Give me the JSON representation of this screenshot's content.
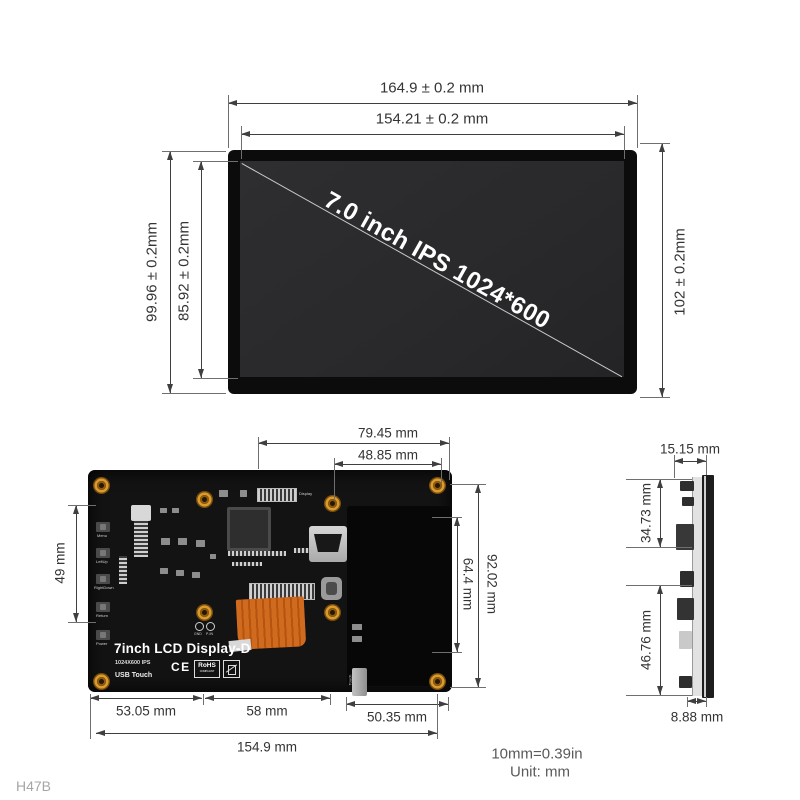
{
  "front_view": {
    "screen_label": "7.0 inch IPS 1024*600",
    "dims": {
      "width_outer": "164.9 ± 0.2 mm",
      "width_inner": "154.21 ± 0.2 mm",
      "height_outer_left": "99.96 ± 0.2mm",
      "height_inner_left": "85.92 ± 0.2mm",
      "height_right": "102 ± 0.2mm"
    }
  },
  "back_view": {
    "board_title": "7inch LCD Display-D",
    "board_resolution": "1024X600 IPS",
    "board_touch": "USB Touch",
    "buttons": [
      "Menu",
      "LeftUp",
      "RightDown",
      "Return",
      "Power"
    ],
    "labels": {
      "display_connector": "Display",
      "touch_connector": "Touch",
      "gnd": "GND",
      "pin": "P-IN"
    },
    "certs": {
      "ce": "CE",
      "rohs": "RoHS",
      "rohs_sub": "COMPLIANT"
    },
    "dims": {
      "top_outer": "79.45 mm",
      "top_inner": "48.85 mm",
      "left": "49 mm",
      "right_outer": "92.02 mm",
      "right_inner": "64.4 mm",
      "bottom_left": "53.05 mm",
      "bottom_mid": "58 mm",
      "bottom_right": "50.35 mm",
      "bottom_total": "154.9 mm"
    }
  },
  "side_view": {
    "dims": {
      "top": "15.15 mm",
      "upper": "34.73 mm",
      "lower": "46.76 mm",
      "bottom": "8.88 mm"
    }
  },
  "footnote": {
    "conversion": "10mm=0.39in",
    "unit": "Unit: mm"
  },
  "watermark": "H47B",
  "colors": {
    "dimension": "#3f3f3f",
    "pcb": "#131313",
    "bezel": "#0c0c0c",
    "screen": "#2a2a2c",
    "standoff": "#d99a2e",
    "flex_cable": "#cf6318"
  }
}
